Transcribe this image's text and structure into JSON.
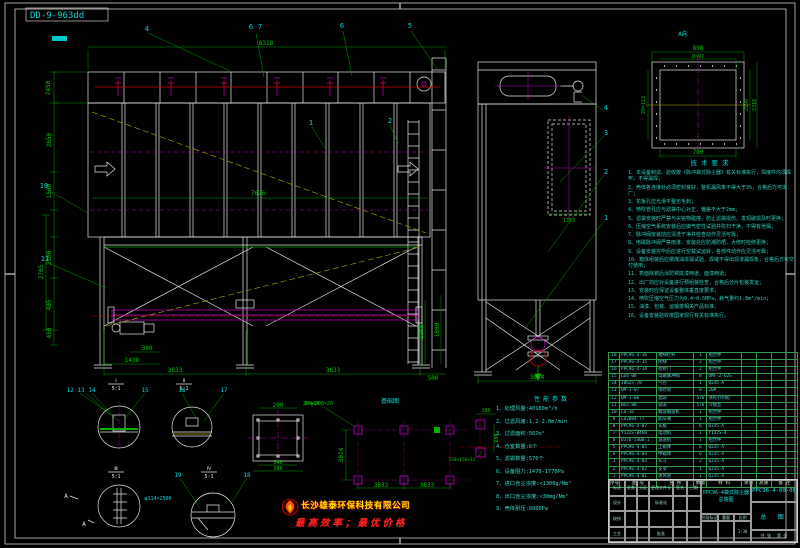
{
  "doc_label": "DD-9-963dd",
  "colors": {
    "line": "#e6e6e6",
    "dim": "#00c800",
    "callout": "#00d8d8",
    "magenta": "#c800c8",
    "red": "#d40000",
    "yellow": "#b0b000"
  },
  "front_view": {
    "dims": {
      "top": "8318",
      "body": "7626",
      "h2450": "2450",
      "h2650": "2650",
      "h1500": "1500",
      "h2100": "2100",
      "h2705": "2705",
      "h405": "405",
      "h450": "450",
      "b390": "390",
      "b1438": "1438",
      "b3633a": "3633",
      "b3633b": "3633",
      "b500": "500",
      "r1200": "1200",
      "r1800": "1800"
    },
    "callouts": {
      "c4": "4",
      "c6a": "6",
      "c7": "7",
      "c6b": "6",
      "c5": "5",
      "c1": "1",
      "c2": "2",
      "c10": "10",
      "c11": "11"
    }
  },
  "side_view": {
    "dims": {
      "width": "3014",
      "door": "1353"
    },
    "callouts": {
      "c4": "4",
      "c3": "3",
      "c2": "2",
      "c1": "1"
    }
  },
  "flange_detail": {
    "label": "A向",
    "dims": {
      "outer_w": "808",
      "bolt_w": "8=97",
      "bolt_h": "20=113",
      "inner_h": "2190",
      "outer_h": "2318",
      "bottom_w": "700"
    }
  },
  "square_detail": {
    "dims": {
      "top": "200",
      "holes": "8=φ14",
      "inner": "540",
      "outer": "580"
    }
  },
  "foundation": {
    "title": "基础图",
    "pad_label": "200×200×20",
    "plate_label": "150×150×12",
    "dims": {
      "w1": "3633",
      "w2": "3633",
      "depth": "3014",
      "d100": "100",
      "d600": "600"
    }
  },
  "detail_views": {
    "labels": [
      "12 13 14",
      "15",
      "16",
      "17",
      "18",
      "19"
    ],
    "markers": [
      {
        "no": "Ⅰ",
        "scale": "5:1"
      },
      {
        "no": "Ⅱ",
        "scale": "5:1"
      },
      {
        "no": "Ⅲ",
        "scale": "5:1"
      },
      {
        "no": "Ⅳ",
        "scale": "5:1"
      }
    ],
    "pipe_label": "φ114×2500",
    "section_a": "A"
  },
  "perf": {
    "title": "性能参数",
    "items": [
      "1、处理风量:40100m³/h",
      "2、过滤风速:1.2-2.0m/min",
      "3、过滤面积:567m²",
      "4、仓室数量:6个",
      "5、滤袋数量:576个",
      "6、设备阻力:1470-1770Pa",
      "7、进口含尘浓度:<1300g/Nm³",
      "8、出口含尘浓度:<30mg/Nm³",
      "9、壳体耐压:6860Pa"
    ]
  },
  "tech_notes": {
    "title": "技术要求",
    "items": [
      "1、本设备制造、验收按《脉冲袋式除尘器》有关标准执行，焊接件均须焊牢，不得漏焊；",
      "2、壳体各连接处必须密封良好，整机漏风率不得大于3%，合格后方可出厂；",
      "3、花板孔应光滑平整无毛刺；",
      "4、喷吹管孔应与滤袋中心对正，偏差不大于2mm；",
      "5、滤袋安装时严禁与尖锐物碰撞，防止滤袋损伤，发现破损及时更换；",
      "6、压缩空气系统安装后应做气密性试验并吹扫干净，不得有泄漏；",
      "7、脉冲阀安装前应清洗干净并检查动作灵活可靠；",
      "8、电磁脉冲阀严禁雨淋，安装处应防潮防晒，大修时检修更换；",
      "9、设备安装完毕后应进行空载试运转，各部件动作应灵活可靠；",
      "10、箱体组装后应做煤油渗漏试验，焊缝不得出现渗漏现象，合格后方可交付使用；",
      "11、表面除锈后涂防锈底漆两道，面漆两道；",
      "12、出厂前应对设备进行预组装检查，合格后分片包装发运；",
      "13、安装时应保证设备整体垂直度要求；",
      "14、喷吹压缩空气压力为0.4~0.5MPa，耗气量约1.8m³/min；",
      "15、油漆、包装、运输按相关产品标准；",
      "16、设备安装验收按国家现行有关标准执行。"
    ]
  },
  "bom": {
    "headers": [
      "序号",
      "图 号",
      "名 称",
      "数量",
      "材 料",
      "单重",
      "总重",
      "备 注"
    ],
    "rows": [
      {
        "no": "18",
        "code": "PPC96-4-16",
        "name": "楼梯栏杆",
        "qty": "1",
        "mat": "组合件"
      },
      {
        "no": "17",
        "code": "PPC96-4-15",
        "name": "爬梯",
        "qty": "2",
        "mat": "组合件"
      },
      {
        "no": "16",
        "code": "PPC96-4-14",
        "name": "检修门",
        "qty": "2",
        "mat": "组合件"
      },
      {
        "no": "15",
        "code": "LD4-08",
        "name": "电磁脉冲阀",
        "qty": "8",
        "mat": "DMF-Z-62S"
      },
      {
        "no": "14",
        "code": "JB625-78",
        "name": "气包",
        "qty": "1",
        "mat": "Q235-A"
      },
      {
        "no": "13",
        "code": "QM-1-07",
        "name": "喷吹管",
        "qty": "8",
        "mat": "20#"
      },
      {
        "no": "12",
        "code": "QM-1-06",
        "name": "滤袋",
        "qty": "576",
        "mat": "涤纶针刺毡"
      },
      {
        "no": "11",
        "code": "HG5-88",
        "name": "袋笼",
        "qty": "576",
        "mat": "冷拔丝"
      },
      {
        "no": "10",
        "code": "LD-16",
        "name": "螺旋输送机",
        "qty": "1",
        "mat": "组合件"
      },
      {
        "no": "9",
        "code": "LD2004-77",
        "name": "卸灰阀",
        "qty": "1",
        "mat": "组合件"
      },
      {
        "no": "8",
        "code": "PPC96-4-07",
        "name": "花板",
        "qty": "6",
        "mat": "Q235-A"
      },
      {
        "no": "7",
        "code": "Y132S-0460",
        "name": "电动机",
        "qty": "1",
        "mat": "Y132S-4"
      },
      {
        "no": "6",
        "code": "U176-5400-1",
        "name": "减速机",
        "qty": "1",
        "mat": "组合件"
      },
      {
        "no": "5",
        "code": "PPC96-4-05",
        "name": "上箱体",
        "qty": "6",
        "mat": "Q235-A"
      },
      {
        "no": "4",
        "code": "PPC96-4-04",
        "name": "中箱体",
        "qty": "6",
        "mat": "Q235-A"
      },
      {
        "no": "3",
        "code": "PPC96-4-03",
        "name": "灰斗",
        "qty": "2",
        "mat": "Q235-A"
      },
      {
        "no": "2",
        "code": "PPC96-4-02",
        "name": "支架",
        "qty": "1",
        "mat": "Q235-A"
      },
      {
        "no": "1",
        "code": "PPC96-4-01",
        "name": "进风管",
        "qty": "1",
        "mat": "Q235-A"
      }
    ]
  },
  "title_block": {
    "product": "PPC96-4袋式除尘器",
    "doc_type": "总装图",
    "drawing_no": "PPC96-4-00-00",
    "right_label": "总 图",
    "stage_label": "阶段标记",
    "weight_label": "重量",
    "scale_label": "比例",
    "scale": "1:30",
    "sheets": "共 张",
    "sheet_no": "第 张",
    "rows": {
      "r1": [
        "标记",
        "处数",
        "分区",
        "更改文件号",
        "签名",
        "日期"
      ],
      "design": "设计",
      "check": "校核",
      "craft": "工艺",
      "std": "标准化",
      "approve": "批准"
    }
  },
  "watermark": {
    "company": "长沙雄泰环保科技有限公司",
    "slogan": "最高效率；最优价格"
  }
}
